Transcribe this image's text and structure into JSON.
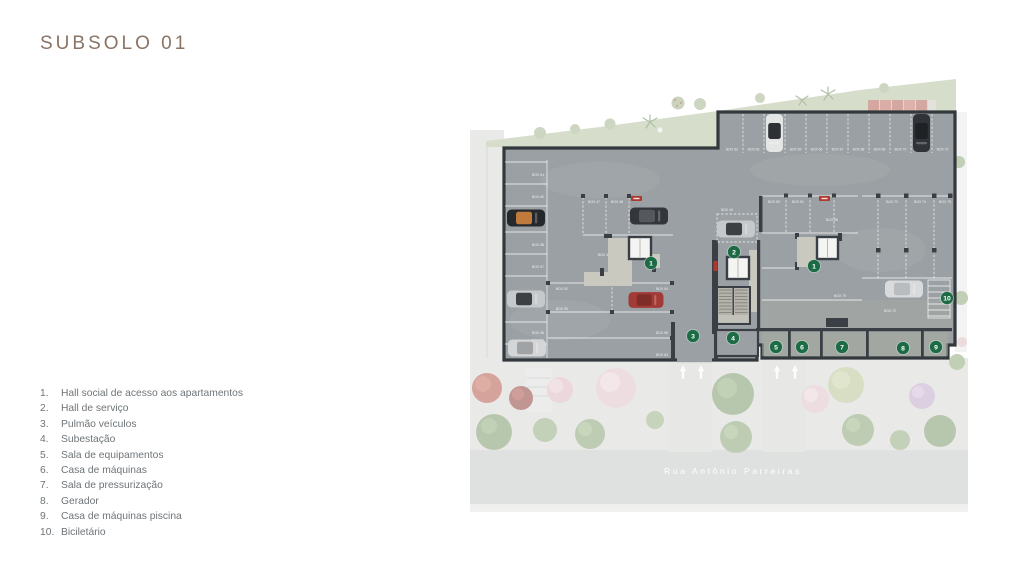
{
  "page": {
    "title": "SUBSOLO 01"
  },
  "legend": {
    "items": [
      {
        "num": "1.",
        "label": "Hall social de acesso aos apartamentos"
      },
      {
        "num": "2.",
        "label": "Hall de serviço"
      },
      {
        "num": "3.",
        "label": "Pulmão veículos"
      },
      {
        "num": "4.",
        "label": "Subestação"
      },
      {
        "num": "5.",
        "label": "Sala de equipamentos"
      },
      {
        "num": "6.",
        "label": "Casa de máquinas"
      },
      {
        "num": "7.",
        "label": "Sala de pressurização"
      },
      {
        "num": "8.",
        "label": "Gerador"
      },
      {
        "num": "9.",
        "label": "Casa de máquinas piscina"
      },
      {
        "num": "10.",
        "label": "Biciletário"
      }
    ]
  },
  "plan": {
    "street_label": "Rua Antônio Parreiras",
    "colors": {
      "marker_green": "#1c6b45",
      "wall": "#3a3f45",
      "floor": "#9aa0a3"
    },
    "markers": [
      {
        "label": "1"
      },
      {
        "label": "2"
      },
      {
        "label": "1"
      },
      {
        "label": "3"
      },
      {
        "label": "4"
      },
      {
        "label": "5"
      },
      {
        "label": "6"
      },
      {
        "label": "7"
      },
      {
        "label": "8"
      },
      {
        "label": "9"
      },
      {
        "label": "10"
      }
    ],
    "stalls_top": [
      "BOX 62",
      "BOX 63",
      "BOX 65",
      "BOX 66",
      "BOX 67",
      "BOX 68",
      "BOX 69",
      "BOX 70",
      "BOX 72"
    ],
    "stalls_left": [
      "BOX 61",
      "BOX 60",
      "BOX 58",
      "BOX 57",
      "BOX 55",
      "BOX 54"
    ],
    "stalls_mid": [
      "BOX 47",
      "BOX 48",
      "BOX 46",
      "BOX 49",
      "BOX 52",
      "BOX 54",
      "BOX 50",
      "BOX 58",
      "BOX 63"
    ],
    "stalls_right": [
      "BOX 50",
      "BOX 51",
      "BOX 56",
      "BOX 79",
      "BOX 73",
      "BOX 74",
      "BOX 75",
      "BOX 72"
    ]
  }
}
